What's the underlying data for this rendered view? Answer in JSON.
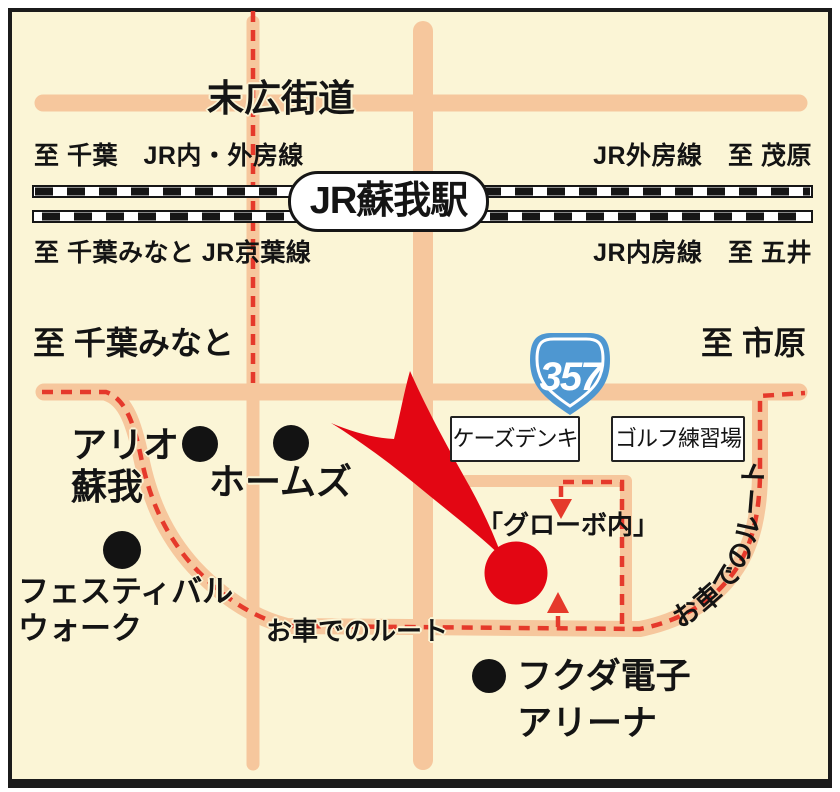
{
  "colors": {
    "background": "#FBF5D6",
    "road": "#F6C79D",
    "route_red_dash": "#E5392B",
    "marker_red": "#E30613",
    "shield_blue": "#4E97D1",
    "rail_black": "#161616"
  },
  "roads": {
    "suehiro_label": "末広街道"
  },
  "railway": {
    "station_label": "JR蘇我駅",
    "top_left": "至 千葉　JR内・外房線",
    "top_right": "JR外房線　至 茂原",
    "bottom_left": "至 千葉みなと JR京葉線",
    "bottom_right": "JR内房線　至 五井"
  },
  "directions": {
    "left": "至 千葉みなと",
    "right": "至 市原"
  },
  "route_shield": {
    "number": "357"
  },
  "landmarks": {
    "ks_denki": "ケーズデンキ",
    "golf_range": "ゴルフ練習場",
    "ario_soga": "アリオ\n蘇我",
    "homes": "ホームズ",
    "festival_walk": "フェスティバル\nウォーク",
    "globo": "「グローボ内」",
    "fukuda_arena": "フクダ電子\nアリーナ"
  },
  "route": {
    "label_bottom": "お車でのルート",
    "label_curve": "お車でのルート"
  }
}
